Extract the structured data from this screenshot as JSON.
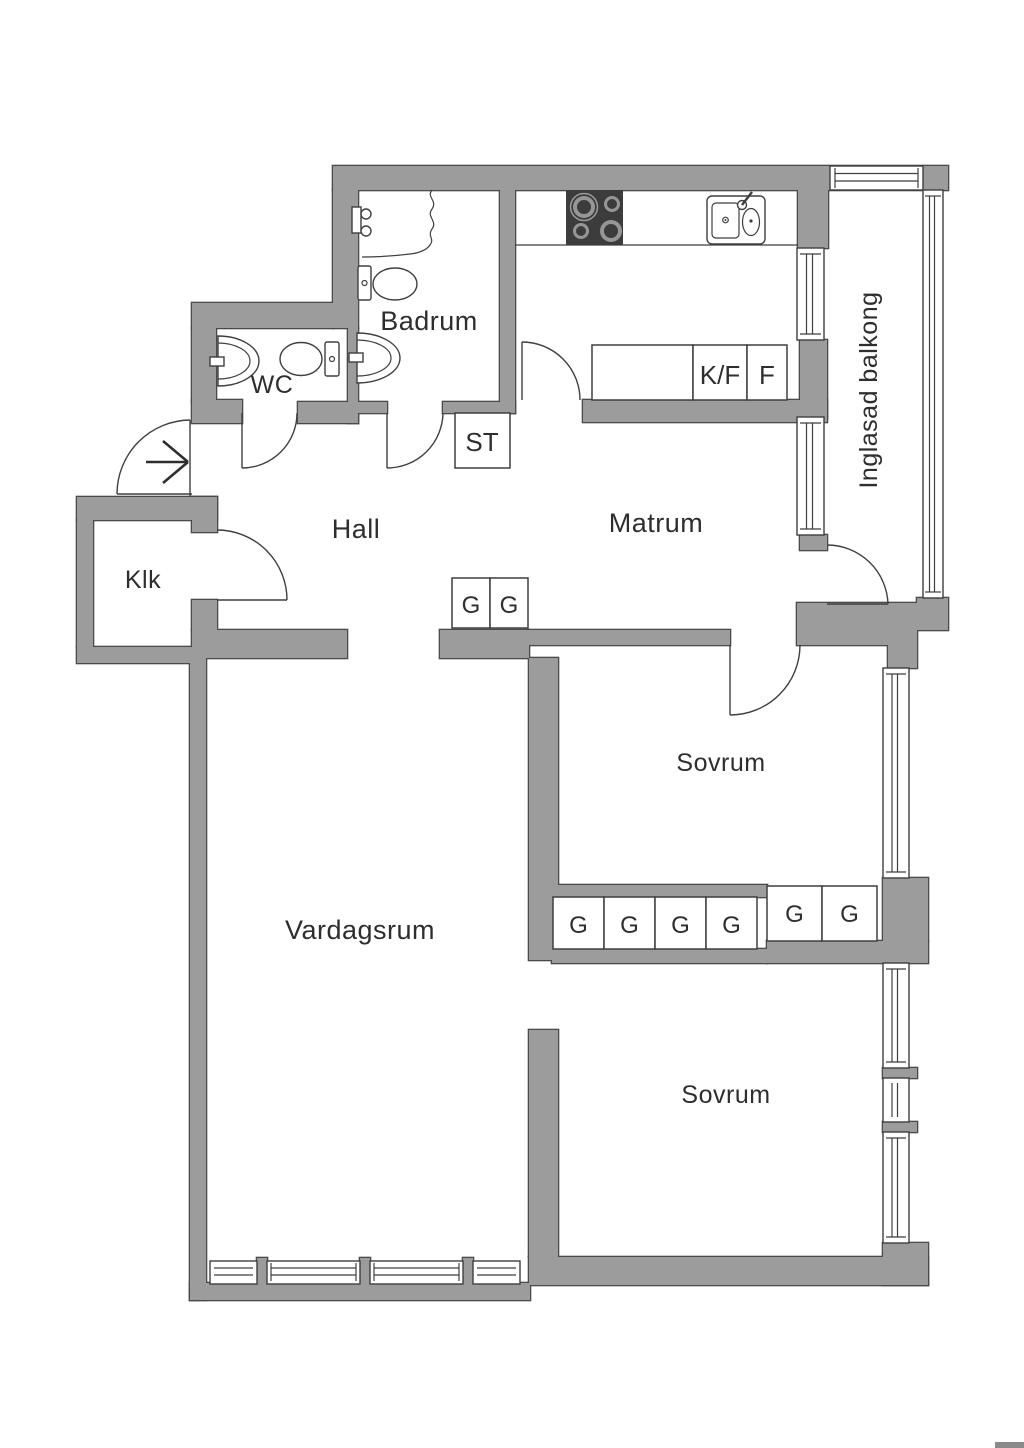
{
  "plan": {
    "type": "apartment-floor-plan",
    "rooms": {
      "hall": "Hall",
      "klk": "Klk",
      "wc": "WC",
      "badrum": "Badrum",
      "matrum": "Matrum",
      "vardagsrum": "Vardagsrum",
      "sovrum_upper": "Sovrum",
      "sovrum_lower": "Sovrum",
      "balcony": "Inglasad balkong"
    },
    "closets": {
      "st": "ST",
      "g": "G",
      "kf": "K/F",
      "f": "F"
    },
    "colors": {
      "wall": "#9c9c9c",
      "wall_edge": "#4a4a4a",
      "line": "#3f3f3f",
      "stove": "#3c3c3c",
      "text": "#2e2e2e",
      "background": "#ffffff"
    },
    "icons": {
      "entry_arrow": "entry-direction-arrow",
      "shower": "shower-mixer-icon",
      "toilet": "toilet-icon",
      "sink": "sink-icon",
      "stove": "stove-burners-icon",
      "kitchen_sink": "double-basin-sink-icon"
    }
  }
}
